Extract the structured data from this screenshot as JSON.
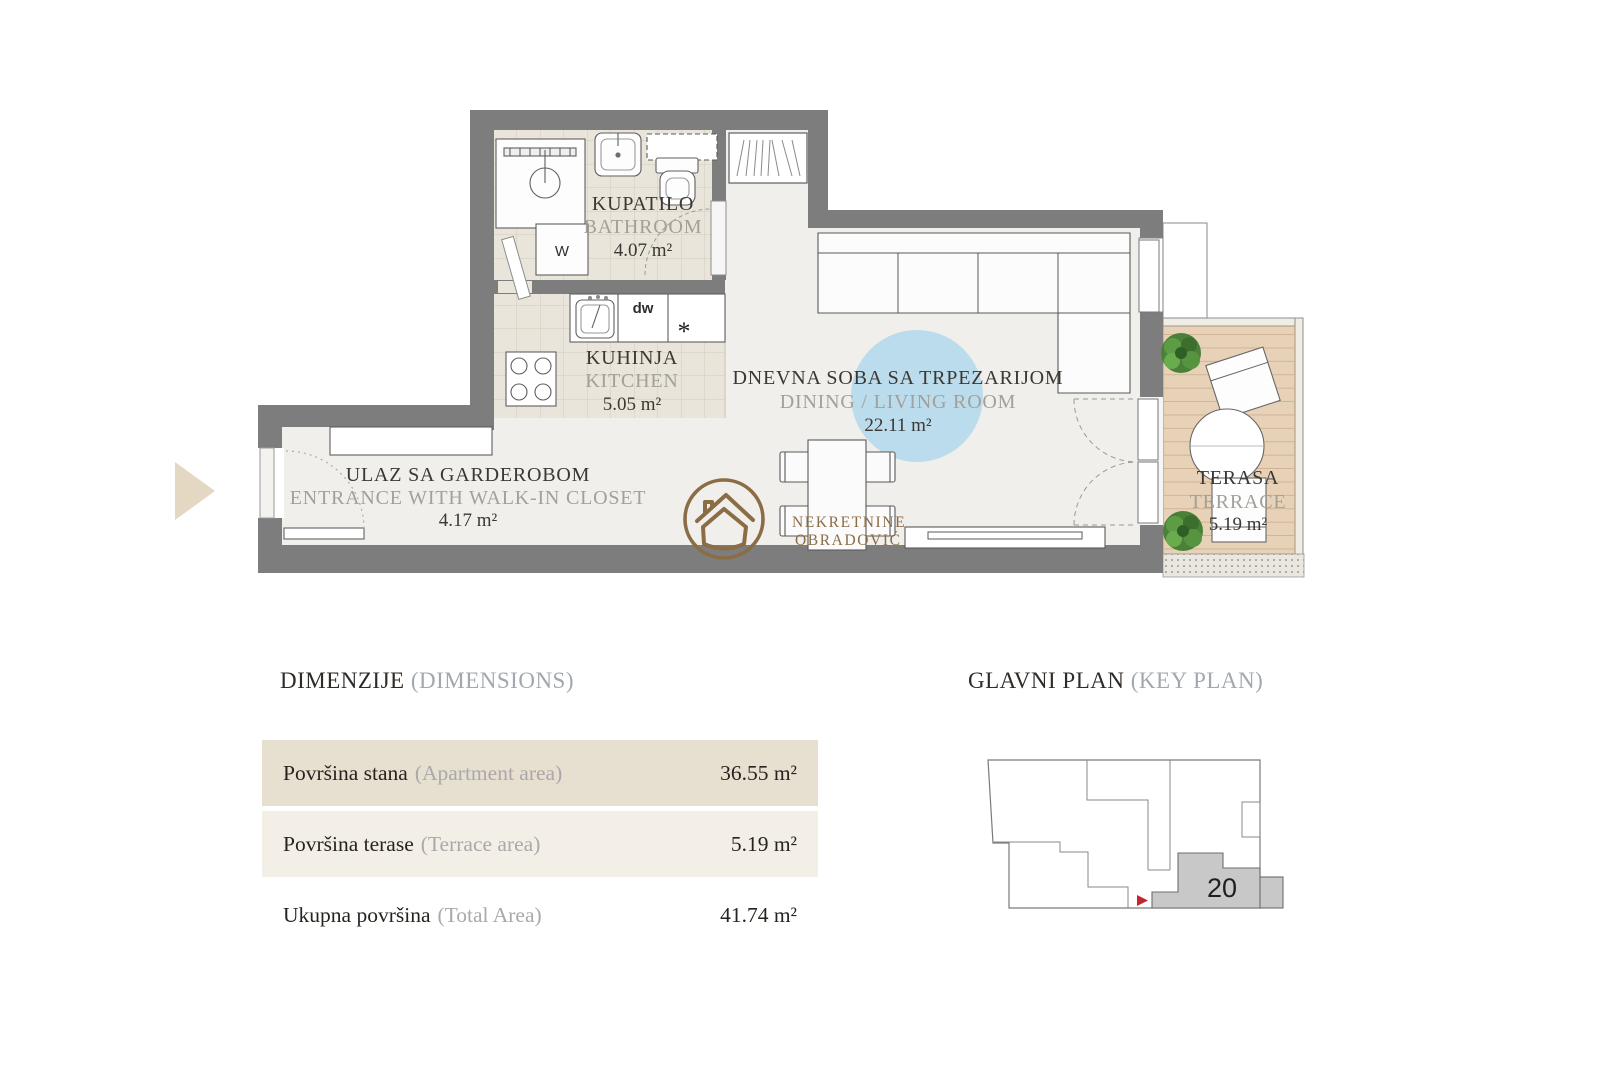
{
  "floor_plan": {
    "rooms": [
      {
        "name": "KUPATILO",
        "name_en": "BATHROOM",
        "area": "4.07 m²"
      },
      {
        "name": "KUHINJA",
        "name_en": "KITCHEN",
        "area": "5.05 m²"
      },
      {
        "name": "DNEVNA SOBA SA TRPEZARIJOM",
        "name_en": "DINING / LIVING ROOM",
        "area": "22.11 m²"
      },
      {
        "name": "ULAZ SA GARDEROBOM",
        "name_en": "ENTRANCE WITH WALK-IN CLOSET",
        "area": "4.17 m²"
      },
      {
        "name": "TERASA",
        "name_en": "TERRACE",
        "area": "5.19 m²"
      }
    ],
    "appliances": {
      "washer": "W",
      "dishwasher": "dw",
      "freezer_star": "*"
    },
    "logo": {
      "line1": "NEKRETNINE",
      "line2": "OBRADOVIĆ"
    }
  },
  "dimensions_section": {
    "title": "DIMENZIJE",
    "subtitle": "(DIMENSIONS)",
    "rows": [
      {
        "label_sr": "Površina stana",
        "label_en": "(Apartment area)",
        "value": "36.55 m²"
      },
      {
        "label_sr": "Površina terase",
        "label_en": "(Terrace area)",
        "value": "5.19 m²"
      },
      {
        "label_sr": "Ukupna površina",
        "label_en": "(Total Area)",
        "value": "41.74 m²"
      }
    ]
  },
  "key_plan_section": {
    "title": "GLAVNI PLAN",
    "subtitle": "(KEY PLAN)",
    "unit_number": "20"
  },
  "colors": {
    "wall_gray": "#7d7d7d",
    "floor_light": "#f1efeb",
    "tile_floor": "#eae5db",
    "deck_tan": "#e8d2b7",
    "rug_blue": "#badcec",
    "brand_brown": "#8a6d45",
    "highlight_red": "#c2272e",
    "arrow_beige": "#e4d8c3",
    "row_beige_dark": "#e7dfd0",
    "row_beige_light": "#f3efe7",
    "keyplan_unit_gray": "#c8c8c8"
  }
}
